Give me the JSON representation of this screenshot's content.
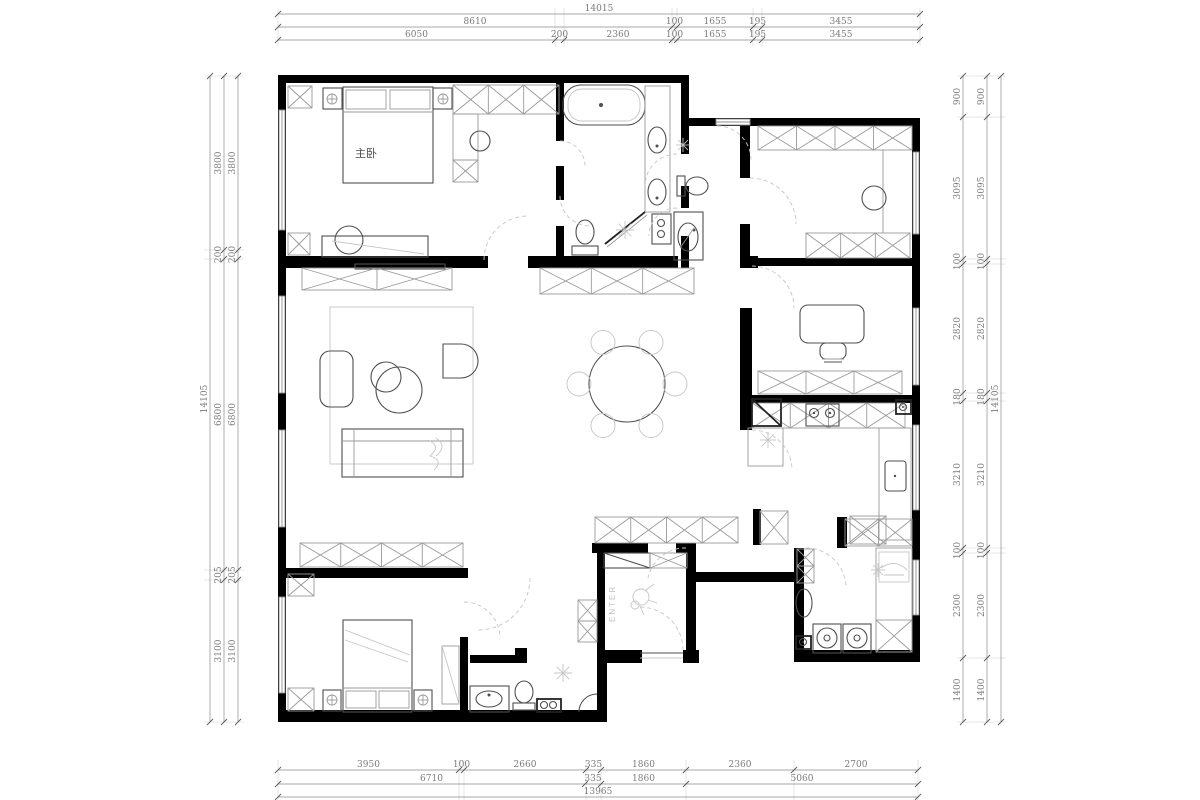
{
  "page": {
    "background": "#ffffff"
  },
  "plan": {
    "room_labels": {
      "master_bedroom": "主卧",
      "entry": "ENTER"
    },
    "colors": {
      "wall": "#000000",
      "dim_text": "#7a7a7a",
      "furniture_dark": "#4f4f4f",
      "furniture_mid": "#9a9a9a",
      "furniture_light": "#c6c6c6"
    }
  },
  "dimensions": {
    "top": {
      "total": "14015",
      "row_mid": [
        "8610",
        "100",
        "1655",
        "195",
        "3455"
      ],
      "row_inner": [
        "6050",
        "200",
        "2360",
        "100",
        "1655",
        "195",
        "3455"
      ]
    },
    "left": {
      "total": "14105",
      "col": [
        "3800",
        "200",
        "6800",
        "205",
        "3100"
      ]
    },
    "right": {
      "total": "14105",
      "col": [
        "900",
        "3095",
        "100",
        "2820",
        "180",
        "3210",
        "100",
        "2300",
        "1400"
      ]
    },
    "bottom": {
      "total": "13965",
      "row_inner": [
        "3950",
        "100",
        "2660",
        "335",
        "1860",
        "2360",
        "2700"
      ],
      "row_mid": [
        "6710",
        "335",
        "1860",
        "5060"
      ]
    }
  }
}
